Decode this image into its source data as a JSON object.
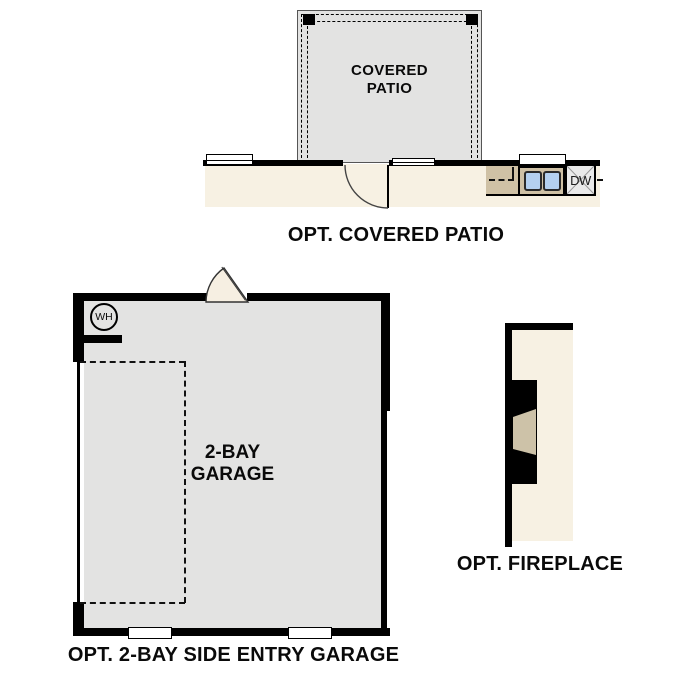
{
  "colors": {
    "wall": "#000000",
    "floor_hard": "#e3e3e2",
    "floor_interior": "#f7f1e3",
    "counter": "#cfc1a5",
    "sink": "#b4d0ef",
    "hearth": "#cdc2a8",
    "dishwasher": "#eaeaea"
  },
  "patio": {
    "label_line1": "COVERED",
    "label_line2": "PATIO",
    "dishwasher_label": "DW",
    "caption": "OPT. COVERED PATIO"
  },
  "garage": {
    "label_line1": "2-BAY",
    "label_line2": "GARAGE",
    "water_heater_label": "WH",
    "caption": "OPT. 2-BAY SIDE ENTRY GARAGE"
  },
  "fireplace": {
    "caption": "OPT. FIREPLACE"
  }
}
